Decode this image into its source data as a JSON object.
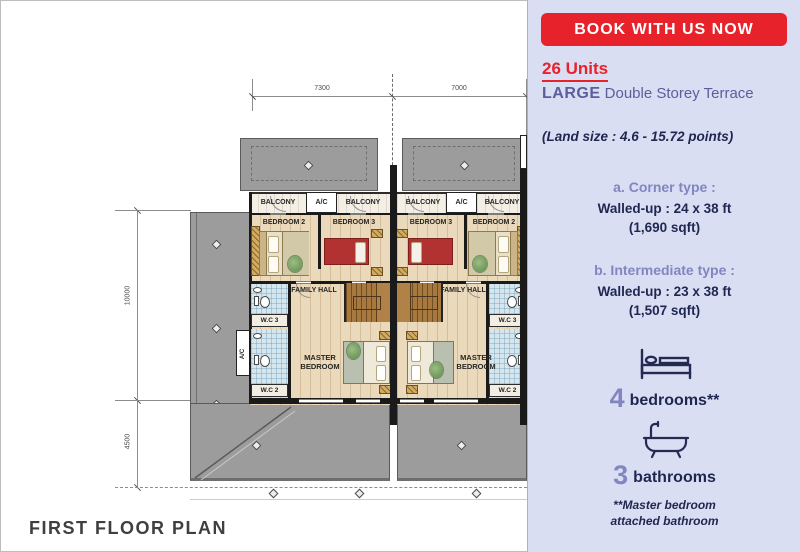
{
  "page": {
    "title_bottom": "FIRST FLOOR PLAN"
  },
  "panel": {
    "banner_label": "BOOK WITH US NOW",
    "units_count": "26 Units",
    "type_bold": "LARGE",
    "type_rest": " Double Storey Terrace",
    "land_size": "(Land size : 4.6 - 15.72 points)",
    "corner": {
      "heading": "a. Corner type :",
      "line1": "Walled-up : 24 x 38 ft",
      "line2": "(1,690 sqft)"
    },
    "intermediate": {
      "heading": "b. Intermediate type :",
      "line1": "Walled-up : 23 x 38 ft",
      "line2": "(1,507 sqft)"
    },
    "bedrooms": {
      "count": "4",
      "label": "bedrooms**"
    },
    "bathrooms": {
      "count": "3",
      "label": "bathrooms"
    },
    "footnote_line1": "**Master bedroom",
    "footnote_line2": "attached bathroom",
    "colors": {
      "accent_red": "#e8222b",
      "navy": "#1f2750",
      "purple": "#8186c0",
      "slate": "#5b5e9c",
      "panel_bg": "#d9def3"
    }
  },
  "plan": {
    "dimensions": {
      "top_left": "7300",
      "top_right": "7000",
      "left_upper": "10000",
      "left_lower": "4500"
    },
    "rooms": {
      "balcony": "BALCONY",
      "ac": "A/C",
      "bedroom2": "BEDROOM 2",
      "bedroom3": "BEDROOM 3",
      "family_hall": "FAMILY HALL",
      "wc3": "W.C 3",
      "wc2": "W.C 2",
      "master_bedroom": "MASTER BEDROOM"
    }
  }
}
